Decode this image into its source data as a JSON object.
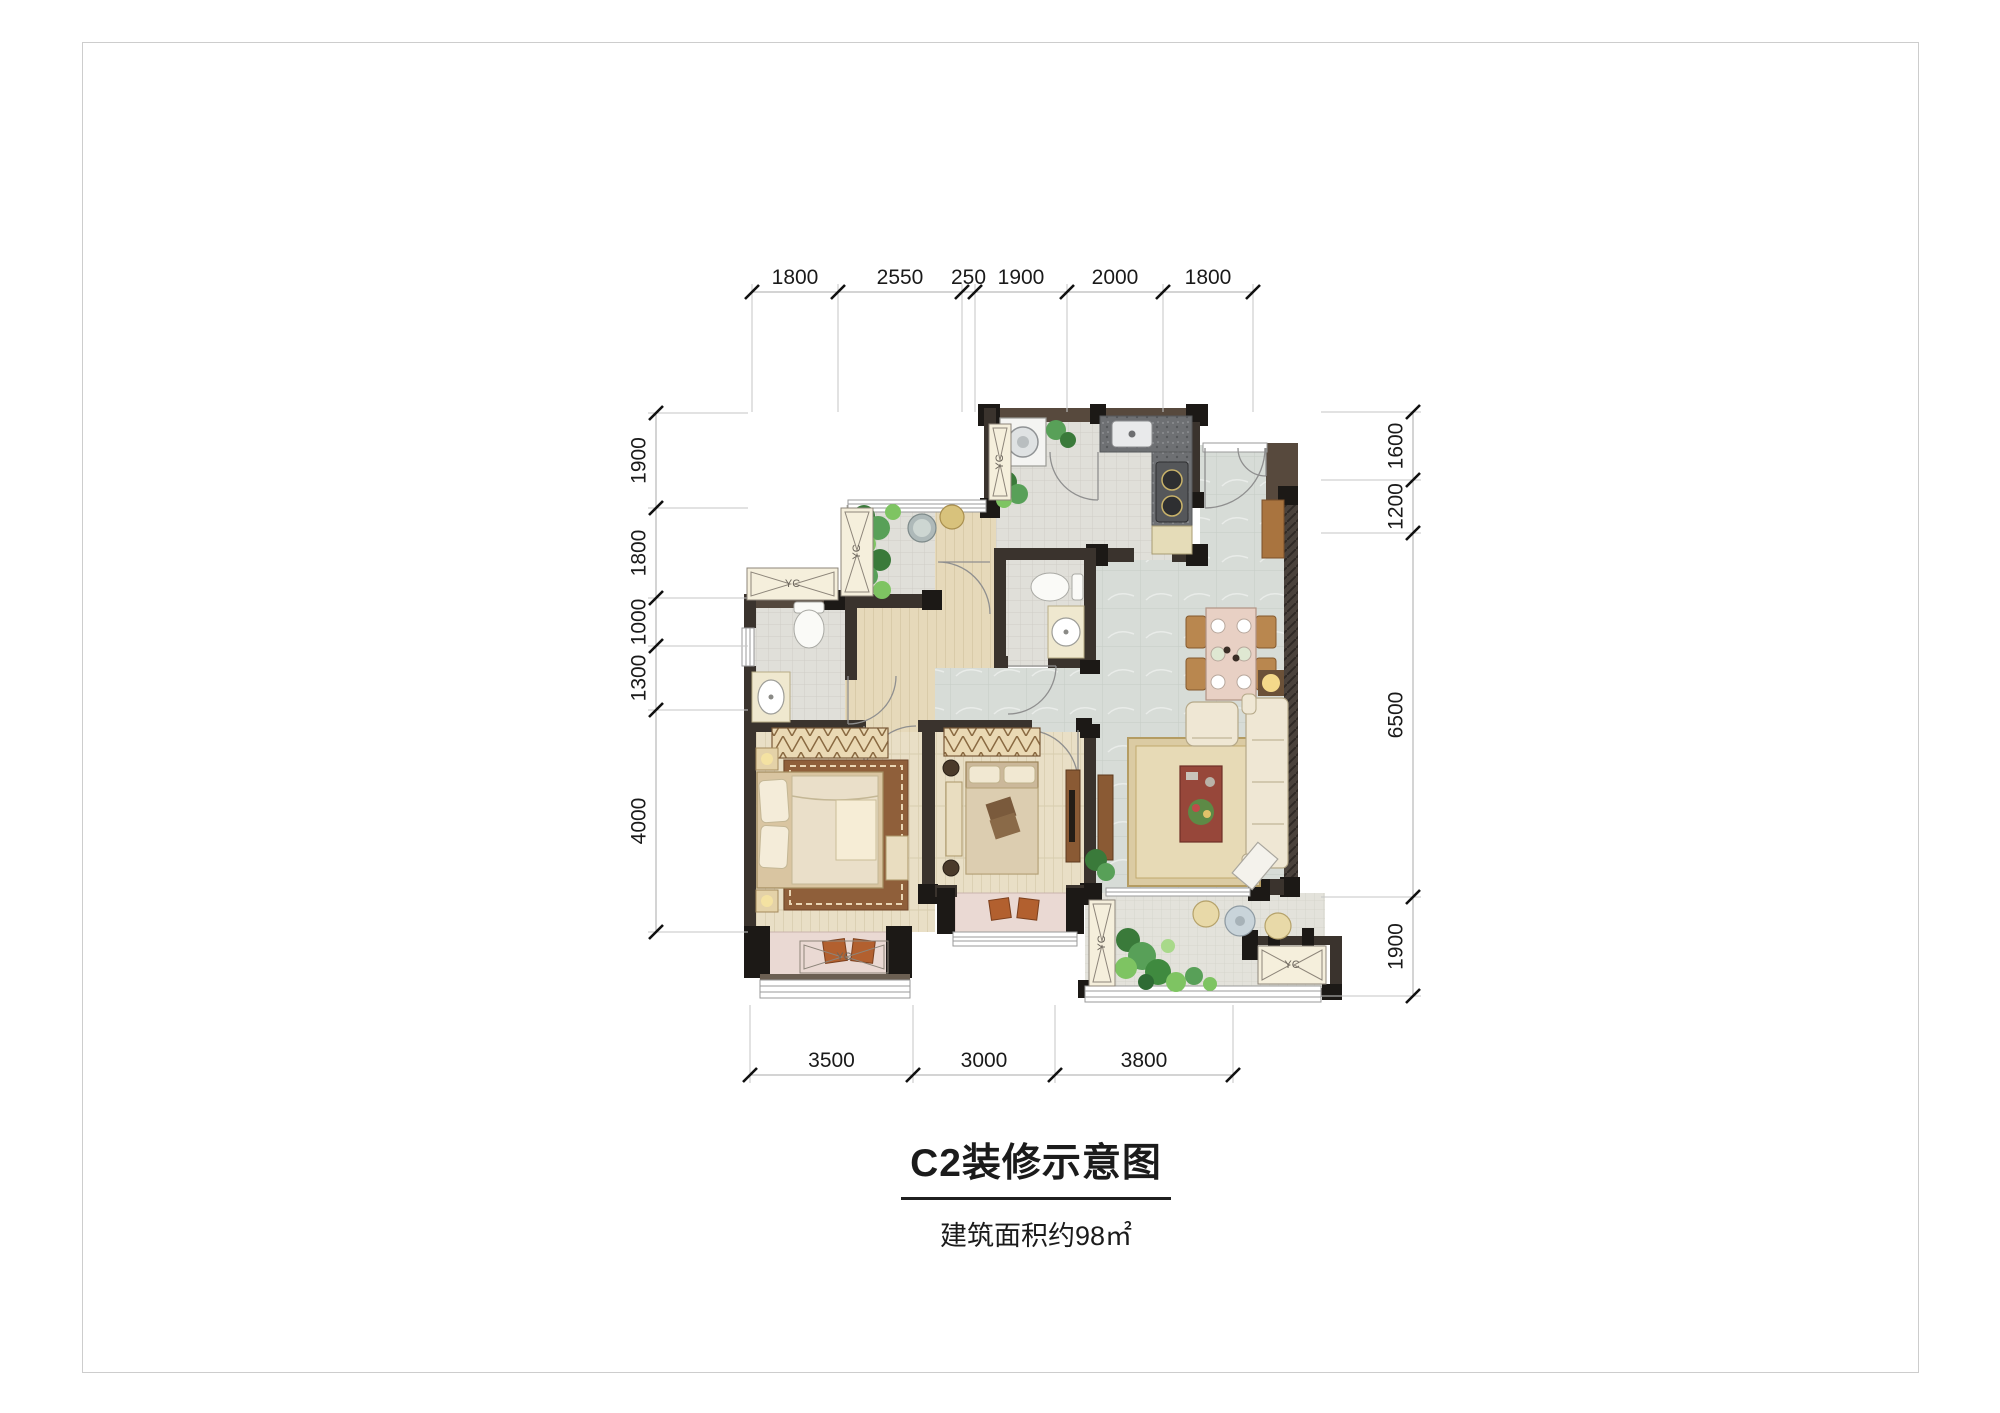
{
  "page": {
    "title": "C2装修示意图",
    "subtitle": "建筑面积约98㎡"
  },
  "colors": {
    "wall_dark": "#3a332d",
    "wall_brown": "#57493d",
    "pillar_black": "#1c1916",
    "marble_floor": "#d7dcd7",
    "tile_floor": "#e0dfd9",
    "wood_floor": "#e9dfc6",
    "cream_platform": "#f5efdc",
    "bay_pink": "#ead9d3",
    "granite_counter": "#6e7073",
    "dim_text": "#1a1a1a",
    "plant_green": "#4f9e4f"
  },
  "dimensions": {
    "top": {
      "orientation": "h",
      "line": 292,
      "ext_dir": 1,
      "ext_len": 120,
      "ticks": [
        752,
        838,
        962,
        975,
        1067,
        1163,
        1253
      ],
      "labels": [
        "1800",
        "2550",
        "250",
        "1900",
        "2000",
        "1800"
      ]
    },
    "bottom": {
      "orientation": "h",
      "line": 1075,
      "ext_dir": -1,
      "ext_len": 70,
      "ticks": [
        750,
        913,
        1055,
        1233
      ],
      "labels": [
        "3500",
        "3000",
        "3800"
      ]
    },
    "left": {
      "orientation": "v",
      "line": 656,
      "ext_dir": 1,
      "ext_len": 92,
      "ticks": [
        413,
        508,
        598,
        646,
        710,
        932
      ],
      "labels": [
        "1900",
        "1800",
        "1000",
        "1300",
        "4000"
      ]
    },
    "right": {
      "orientation": "v",
      "line": 1413,
      "ext_dir": -1,
      "ext_len": 92,
      "ticks": [
        412,
        480,
        533,
        897,
        996
      ],
      "labels": [
        "1600",
        "1200",
        "6500",
        "1900"
      ]
    }
  },
  "ac_markers": [
    {
      "name": "ac-platform-left-upper",
      "x": 747,
      "y": 568,
      "w": 91,
      "h": 32,
      "vertical": false,
      "bg": true,
      "label": "YC"
    },
    {
      "name": "ac-platform-left-vert",
      "x": 841,
      "y": 508,
      "w": 32,
      "h": 88,
      "vertical": true,
      "bg": true,
      "label": "YC"
    },
    {
      "name": "ac-platform-utility",
      "x": 989,
      "y": 424,
      "w": 22,
      "h": 76,
      "vertical": true,
      "bg": true,
      "label": "YC"
    },
    {
      "name": "ac-marker-master-bay",
      "x": 800,
      "y": 941,
      "w": 88,
      "h": 32,
      "vertical": false,
      "bg": false,
      "label": "YC"
    },
    {
      "name": "ac-platform-balcony-left",
      "x": 1089,
      "y": 900,
      "w": 26,
      "h": 86,
      "vertical": true,
      "bg": true,
      "label": "YC"
    },
    {
      "name": "ac-platform-balcony-right",
      "x": 1258,
      "y": 946,
      "w": 68,
      "h": 38,
      "vertical": false,
      "bg": true,
      "label": "YC"
    }
  ]
}
